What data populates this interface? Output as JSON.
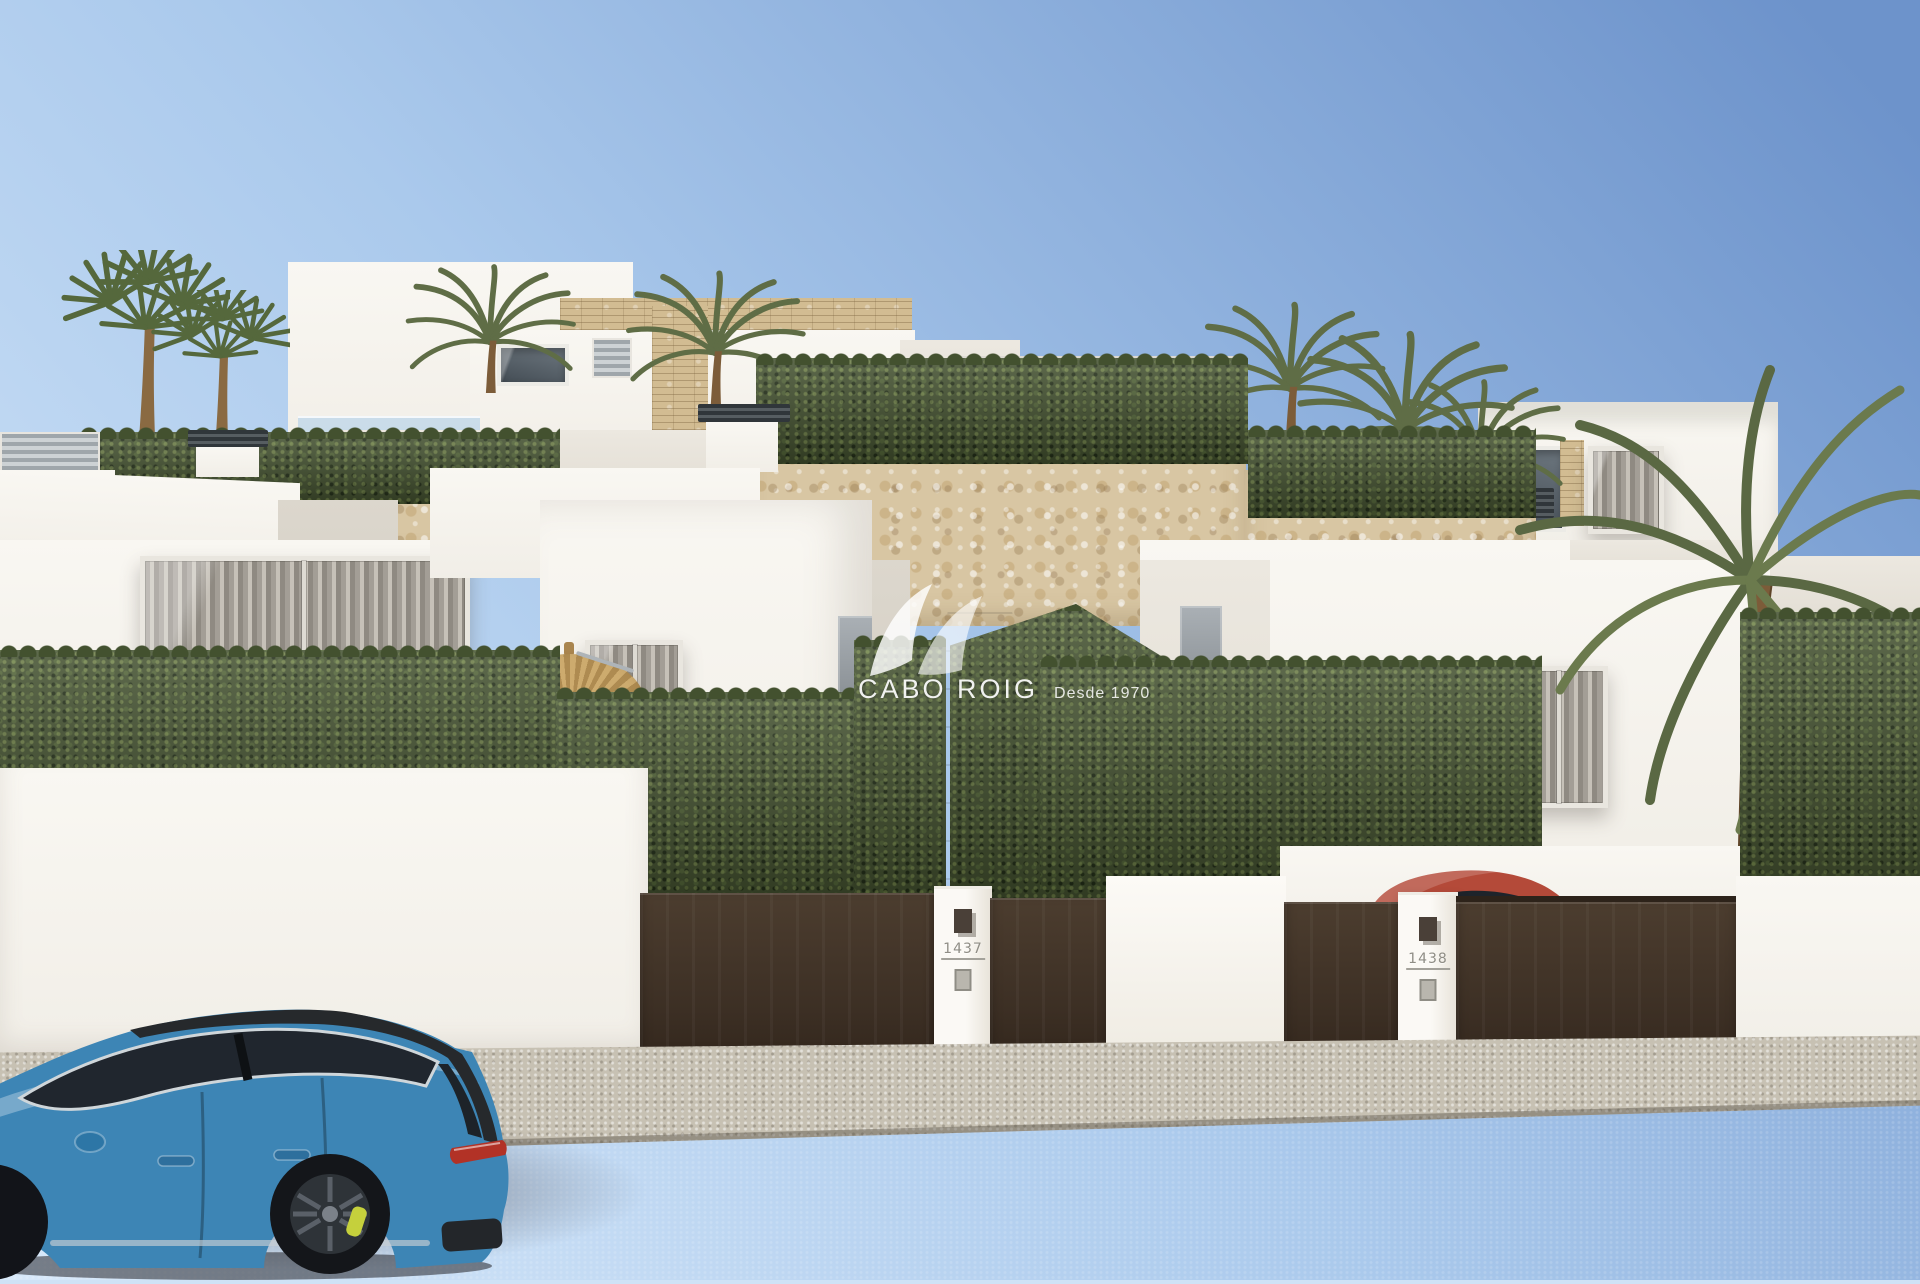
{
  "image": {
    "kind": "3d-architectural-render",
    "subject": "Modern white new-build villas on a terraced street with clipped hedges, stone retaining walls, palm trees, brown entrance gates and a blue estate car parked on the road; a red car sits in one driveway"
  },
  "watermark": {
    "brand": "CABO ROIG",
    "tagline": "Desde 1970",
    "logo_icon": "double-wave-swoosh-logo"
  },
  "gates": {
    "left_plaque_number": "1437",
    "right_plaque_number": "1438"
  },
  "colors": {
    "sky_top": "#6d93cb",
    "sky_mid": "#aac9ec",
    "sky_horizon": "#d8e9fa",
    "wall_white_lit": "#f7f4ee",
    "wall_white_shade": "#d6d0c6",
    "stone": "#d8c6a3",
    "hedge": "#43512f",
    "hedge_light": "#73854c",
    "gate_brown": "#3c2f24",
    "gate_brown_light": "#4c3d2f",
    "sidewalk": "#c7c1b3",
    "road": "#aaa5a8",
    "car_blue": "#3d85b5",
    "car_glass": "#20262e",
    "caliper_yellow": "#c5d03c",
    "taillight_red": "#b23226",
    "red_car": "#b44a39",
    "palm_green": "#5f6d46",
    "trunk_brown": "#7c5c39",
    "umbrella_straw": "#c7a368"
  }
}
